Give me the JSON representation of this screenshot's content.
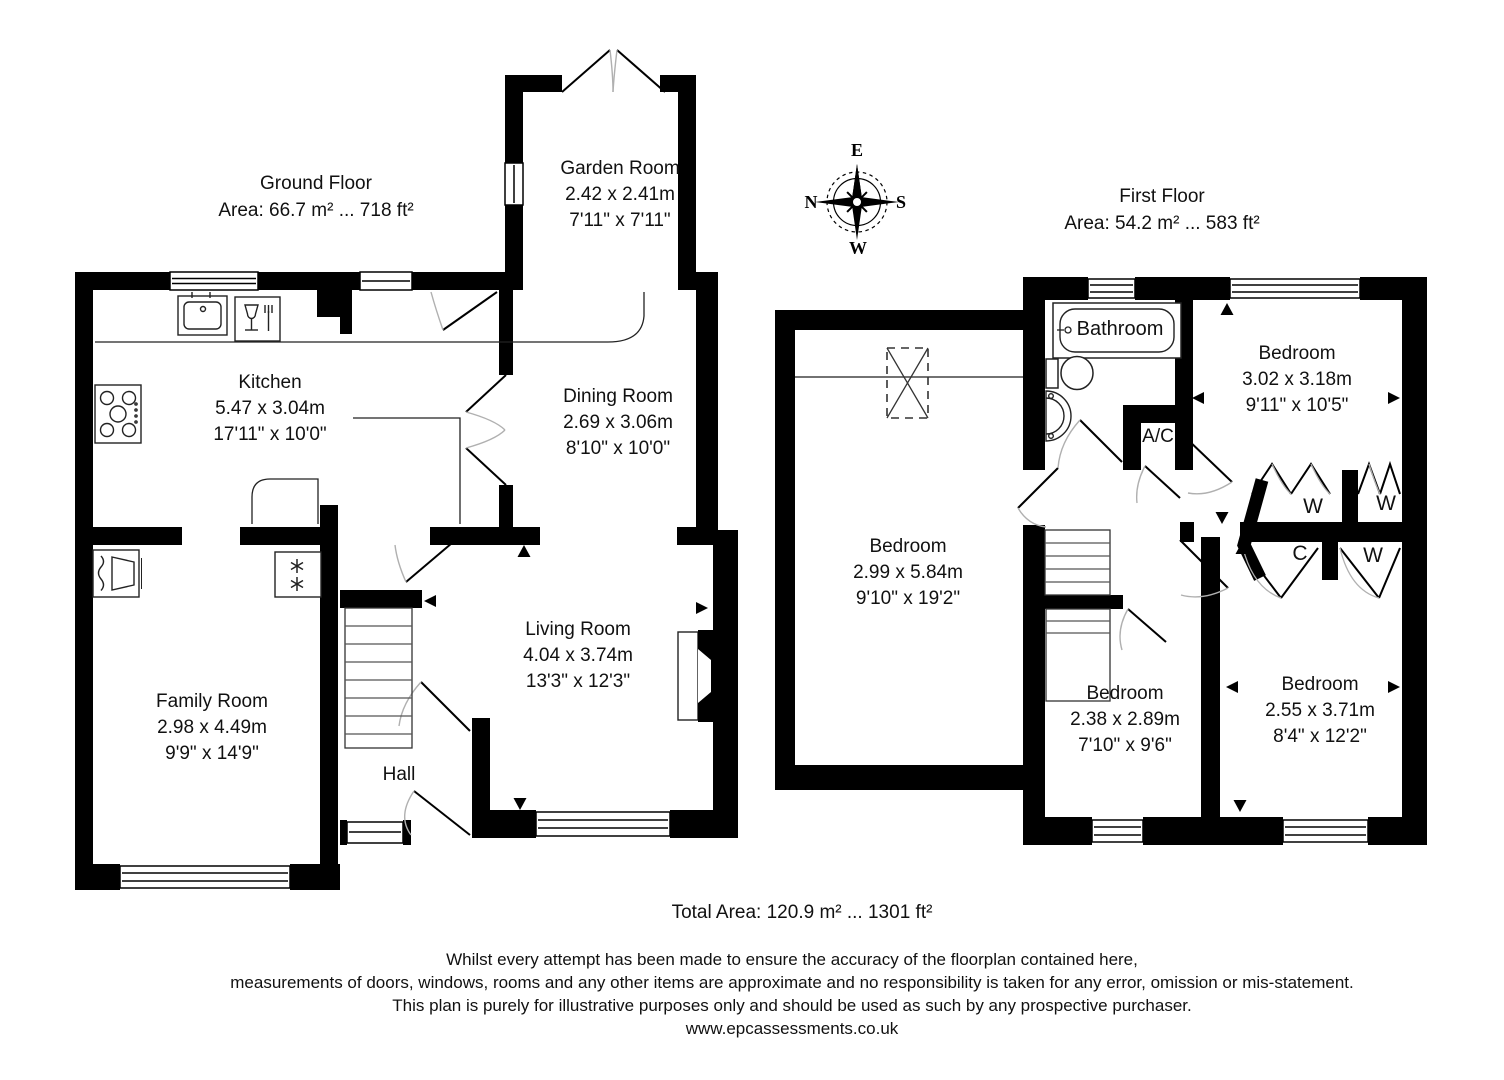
{
  "ground_floor": {
    "title": "Ground Floor",
    "area": "Area: 66.7 m² ... 718 ft²",
    "rooms": {
      "garden_room": {
        "name": "Garden Room",
        "metric": "2.42 x 2.41m",
        "imperial": "7'11\" x 7'11\""
      },
      "kitchen": {
        "name": "Kitchen",
        "metric": "5.47 x 3.04m",
        "imperial": "17'11\" x 10'0\""
      },
      "dining_room": {
        "name": "Dining Room",
        "metric": "2.69 x 3.06m",
        "imperial": "8'10\" x 10'0\""
      },
      "living_room": {
        "name": "Living Room",
        "metric": "4.04 x 3.74m",
        "imperial": "13'3\" x 12'3\""
      },
      "family_room": {
        "name": "Family Room",
        "metric": "2.98 x 4.49m",
        "imperial": "9'9\" x 14'9\""
      },
      "hall": {
        "name": "Hall"
      }
    }
  },
  "first_floor": {
    "title": "First Floor",
    "area": "Area: 54.2 m² ... 583 ft²",
    "rooms": {
      "bathroom": {
        "name": "Bathroom"
      },
      "ac": {
        "name": "A/C"
      },
      "bedroom_top_right": {
        "name": "Bedroom",
        "metric": "3.02 x 3.18m",
        "imperial": "9'11\" x 10'5\""
      },
      "bedroom_left": {
        "name": "Bedroom",
        "metric": "2.99 x 5.84m",
        "imperial": "9'10\" x 19'2\""
      },
      "bedroom_bottom_middle": {
        "name": "Bedroom",
        "metric": "2.38 x 2.89m",
        "imperial": "7'10\" x 9'6\""
      },
      "bedroom_bottom_right": {
        "name": "Bedroom",
        "metric": "2.55 x 3.71m",
        "imperial": "8'4\" x 12'2\""
      },
      "closets": {
        "w1": "W",
        "w2": "W",
        "w3": "W",
        "c": "C"
      }
    }
  },
  "compass": {
    "north": "N",
    "east": "E",
    "south": "S",
    "west": "W"
  },
  "footer": {
    "total_area": "Total Area: 120.9 m² ... 1301 ft²",
    "disclaimer_line_1": "Whilst every attempt has been made to ensure the accuracy of the floorplan contained here,",
    "disclaimer_line_2": "measurements of doors, windows, rooms and any other items are approximate and no responsibility is taken for any error, omission or mis-statement.",
    "disclaimer_line_3": "This plan is purely for illustrative purposes only and should be used as such by any prospective purchaser.",
    "website": "www.epcassessments.co.uk"
  }
}
